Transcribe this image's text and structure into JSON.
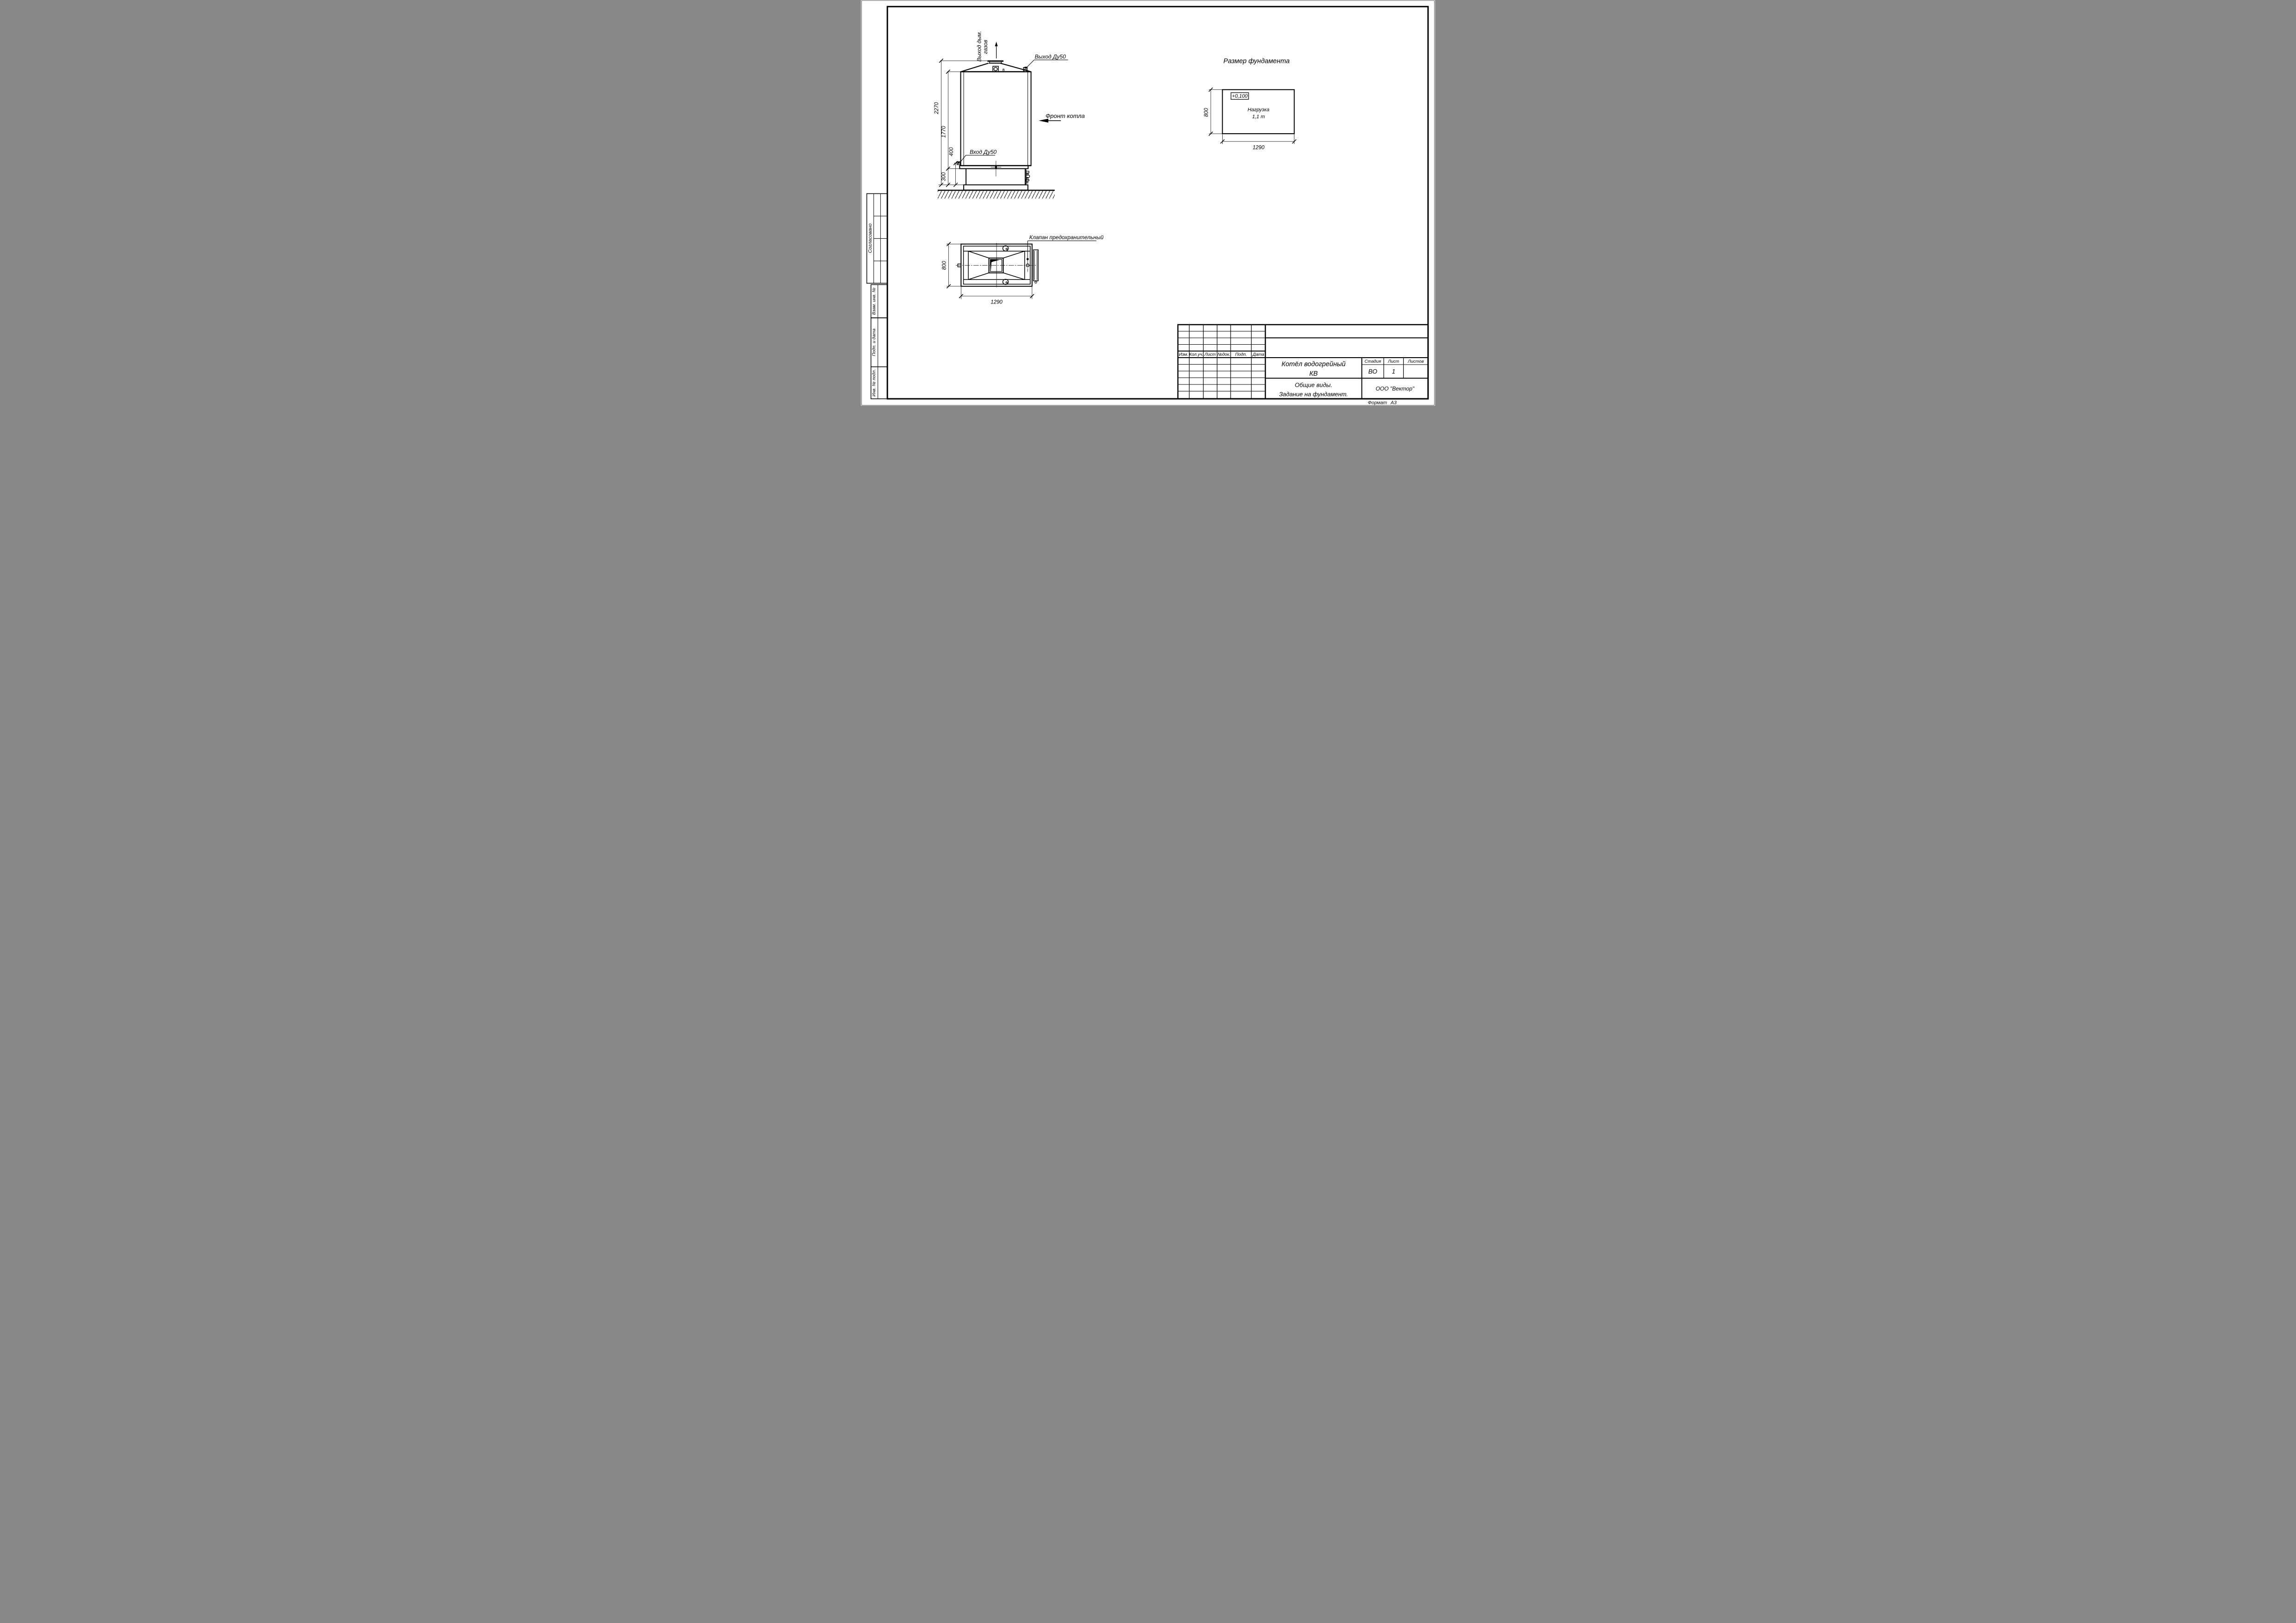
{
  "front_view": {
    "flue_label_line1": "Выход дым.",
    "flue_label_line2": "газов",
    "outlet_label": "Выход Ду50",
    "inlet_label": "Вход Ду50",
    "front_label": "Фронт котла",
    "dims": {
      "total_height": "2270",
      "body_height": "1770",
      "inlet_height": "400",
      "foundation_height": "300"
    }
  },
  "plan_view": {
    "valve_label": "Клапан предохранительный",
    "dims": {
      "width": "1290",
      "depth": "800"
    }
  },
  "foundation_view": {
    "title": "Размер фундамента",
    "elevation": "+0,100",
    "load_line1": "Нагрузка",
    "load_line2": "1,1 т",
    "dims": {
      "width": "1290",
      "depth": "800"
    }
  },
  "title_block": {
    "rev_headers": [
      "Изм.",
      "Кол.уч.",
      "Лист",
      "№док.",
      "Подп.",
      "Дата"
    ],
    "doc_title_line1": "Котёл водогрейный",
    "doc_title_line2": "КВ",
    "stage_header": "Стадия",
    "sheet_header": "Лист",
    "sheets_header": "Листов",
    "stage_value": "ВО",
    "sheet_value": "1",
    "sheets_value": "",
    "subtitle_line1": "Общие виды.",
    "subtitle_line2": "Задание на фундамент.",
    "company": "ООО \"Вектор\"",
    "format_label": "Формат",
    "format_value": "А3"
  },
  "margin_stamps": {
    "agreed": "Согласовано",
    "replace_inv": "Взам. инв. №",
    "sign_date": "Подп. и дата",
    "inv_orig": "Инв. № подл."
  }
}
